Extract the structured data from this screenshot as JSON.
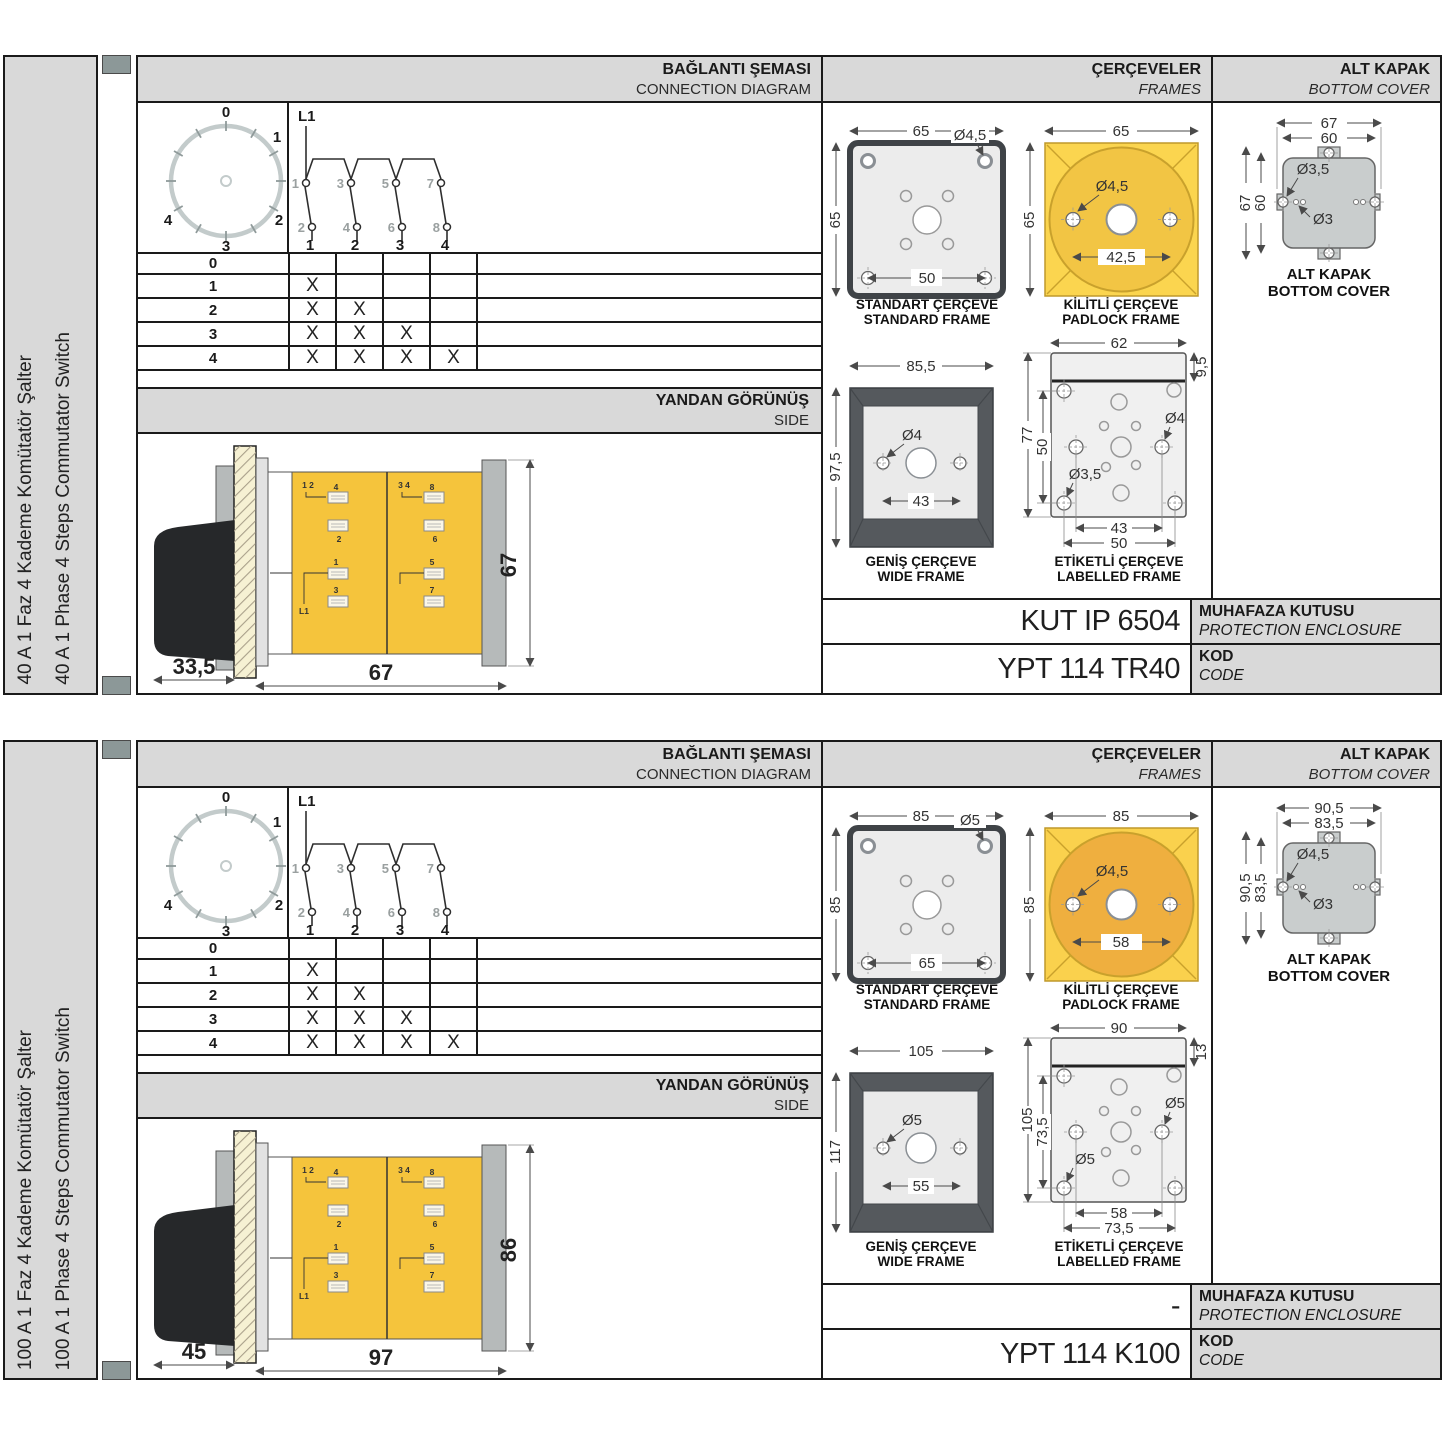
{
  "colors": {
    "panel_gray": "#d9d9d9",
    "accent_yellow": "#f5c43c",
    "frame_dark": "#55595d",
    "cover_gray": "#c9cdcd",
    "strip_block": "#8c9898"
  },
  "labels": {
    "conn_tr": "BAĞLANTI ŞEMASI",
    "conn_en": "CONNECTION DIAGRAM",
    "frames_tr": "ÇERÇEVELER",
    "frames_en": "FRAMES",
    "cover_tr": "ALT KAPAK",
    "cover_en": "BOTTOM COVER",
    "side_tr": "YANDAN GÖRÜNÜŞ",
    "side_en": "SIDE",
    "std_tr": "STANDART ÇERÇEVE",
    "std_en": "STANDARD FRAME",
    "padlock_tr": "KİLİTLİ ÇERÇEVE",
    "padlock_en": "PADLOCK FRAME",
    "wide_tr": "GENİŞ ÇERÇEVE",
    "wide_en": "WIDE FRAME",
    "labelled_tr": "ETİKETLİ ÇERÇEVE",
    "labelled_en": "LABELLED FRAME",
    "cover_cap_tr": "ALT KAPAK",
    "cover_cap_en": "BOTTOM COVER",
    "enclosure_tr": "MUHAFAZA KUTUSU",
    "enclosure_en": "PROTECTION ENCLOSURE",
    "code_tr": "KOD",
    "code_en": "CODE",
    "line": "L1",
    "dial": [
      "0",
      "1",
      "2",
      "3",
      "4"
    ],
    "top_contacts": [
      "1",
      "3",
      "5",
      "7"
    ],
    "bottom_contacts": [
      "2",
      "4",
      "6",
      "8"
    ],
    "terminals": [
      "1",
      "2",
      "3",
      "4"
    ],
    "side_top_left": "1 2",
    "side_top_right": "3 4",
    "side_left_stickers": [
      "4",
      "2",
      "1",
      "3"
    ],
    "side_right_stickers": [
      "8",
      "6",
      "5",
      "7"
    ]
  },
  "table": {
    "rows": [
      {
        "step": "0",
        "marks": [
          "",
          "",
          "",
          ""
        ]
      },
      {
        "step": "1",
        "marks": [
          "X",
          "",
          "",
          ""
        ]
      },
      {
        "step": "2",
        "marks": [
          "X",
          "X",
          "",
          ""
        ]
      },
      {
        "step": "3",
        "marks": [
          "X",
          "X",
          "X",
          ""
        ]
      },
      {
        "step": "4",
        "marks": [
          "X",
          "X",
          "X",
          "X"
        ]
      }
    ]
  },
  "sections": [
    {
      "title_tr": "40 A 1 Faz 4 Kademe Komütatör Şalter",
      "title_en": "40 A 1 Phase 4 Steps Commutator Switch",
      "side_view": {
        "depth": "33,5",
        "width": "67",
        "height": "67"
      },
      "standard_frame": {
        "width": "65",
        "height": "65",
        "hole_dia": "Ø4,5",
        "spacing": "50"
      },
      "padlock_frame": {
        "width": "65",
        "height": "65",
        "hole_dia": "Ø4,5",
        "spacing": "42,5",
        "square_color": "#fbd54f",
        "circle_color": "#f2c544"
      },
      "wide_frame": {
        "width": "85,5",
        "height": "97,5",
        "hole_dia": "Ø4",
        "spacing": "43"
      },
      "labelled_frame": {
        "width": "62",
        "strip": "9,5",
        "height": "77",
        "height_inner": "50",
        "hole_dia": "Ø4",
        "hole_dia2": "Ø3,5",
        "spacing1": "43",
        "spacing2": "50"
      },
      "bottom_cover": {
        "outer_w": "67",
        "inner_w": "60",
        "outer_h": "67",
        "inner_h": "60",
        "hole_dia": "Ø3,5",
        "hole_dia2": "Ø3"
      },
      "enclosure": "KUT IP 6504",
      "code": "YPT 114 TR40"
    },
    {
      "title_tr": "100 A 1 Faz 4 Kademe Komütatör Şalter",
      "title_en": "100 A 1 Phase 4 Steps Commutator Switch",
      "side_view": {
        "depth": "45",
        "width": "97",
        "height": "86"
      },
      "standard_frame": {
        "width": "85",
        "height": "85",
        "hole_dia": "Ø5",
        "spacing": "65"
      },
      "padlock_frame": {
        "width": "85",
        "height": "85",
        "hole_dia": "Ø4,5",
        "spacing": "58",
        "square_color": "#fad14d",
        "circle_color": "#efaf3f"
      },
      "wide_frame": {
        "width": "105",
        "height": "117",
        "hole_dia": "Ø5",
        "spacing": "55"
      },
      "labelled_frame": {
        "width": "90",
        "strip": "13",
        "height": "105",
        "height_inner": "73,5",
        "hole_dia": "Ø5",
        "hole_dia2": "Ø5",
        "spacing1": "58",
        "spacing2": "73,5"
      },
      "bottom_cover": {
        "outer_w": "90,5",
        "inner_w": "83,5",
        "outer_h": "90,5",
        "inner_h": "83,5",
        "hole_dia": "Ø4,5",
        "hole_dia2": "Ø3"
      },
      "enclosure": "-",
      "code": "YPT 114 K100"
    }
  ]
}
